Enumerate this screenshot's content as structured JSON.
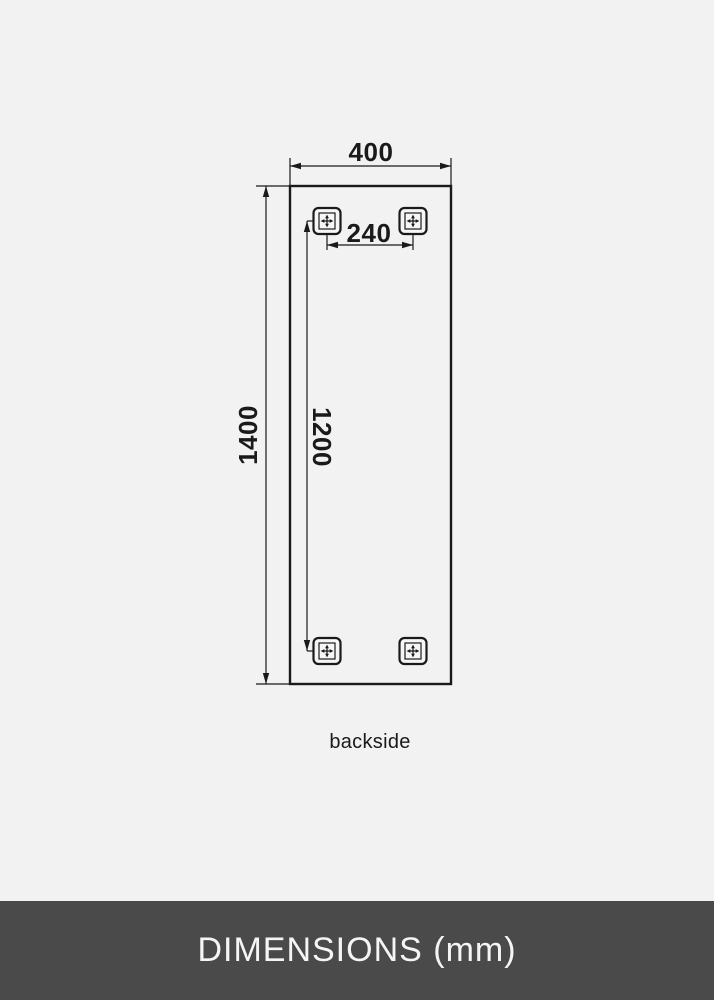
{
  "colors": {
    "bg": "#f2f2f2",
    "line": "#1a1a1a",
    "footer-bg": "#4a4a4a",
    "footer-text": "#f5f5f5"
  },
  "diagram": {
    "caption": "backside",
    "dimension_labels": {
      "width": "400",
      "height": "1400",
      "bracket_spacing_horizontal": "240",
      "bracket_spacing_vertical": "1200"
    }
  },
  "footer": {
    "title": "DIMENSIONS (mm)"
  }
}
